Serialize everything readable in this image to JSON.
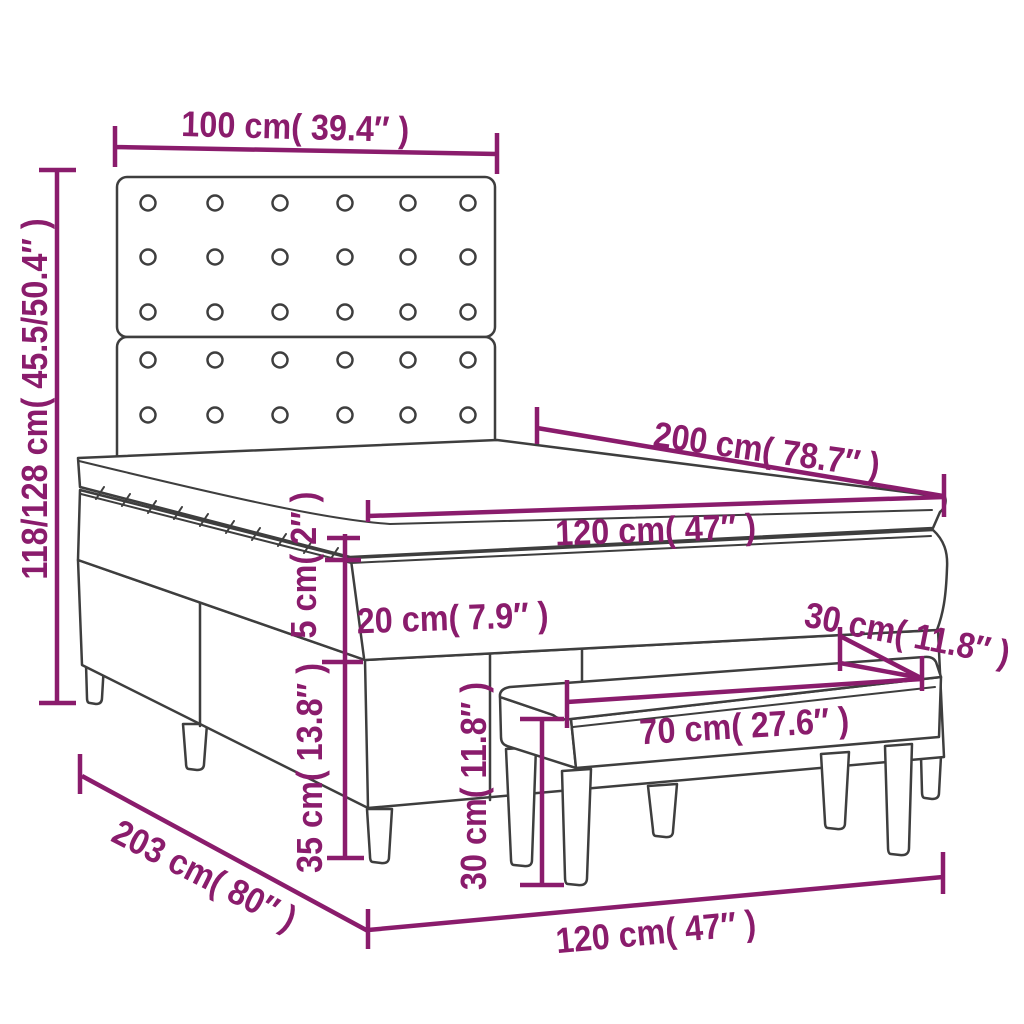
{
  "diagram": {
    "kind": "furniture-dimension-diagram",
    "subject": "box spring bed with tufted headboard, mattress topper and bench",
    "colors": {
      "dimension": "#8a1c6c",
      "outline": "#3e3e3e",
      "background": "#ffffff"
    },
    "labels": {
      "headboard_width": "100 cm( 39.4″ )",
      "overall_height": "118/128 cm( 45.5/50.4″ )",
      "bed_length": "200 cm( 78.7″ )",
      "bed_width_top": "120 cm( 47″ )",
      "topper_thickness": "5 cm( 2″ )",
      "mattress_thickness": "20 cm( 7.9″ )",
      "bench_depth": "30 cm( 11.8″ )",
      "bench_width": "70 cm( 27.6″ )",
      "base_height": "35 cm( 13.8″ )",
      "bench_height": "30 cm( 11.8″ )",
      "bed_length_total": "203 cm( 80″ )",
      "bed_width_bottom": "120 cm( 47″ )"
    }
  }
}
